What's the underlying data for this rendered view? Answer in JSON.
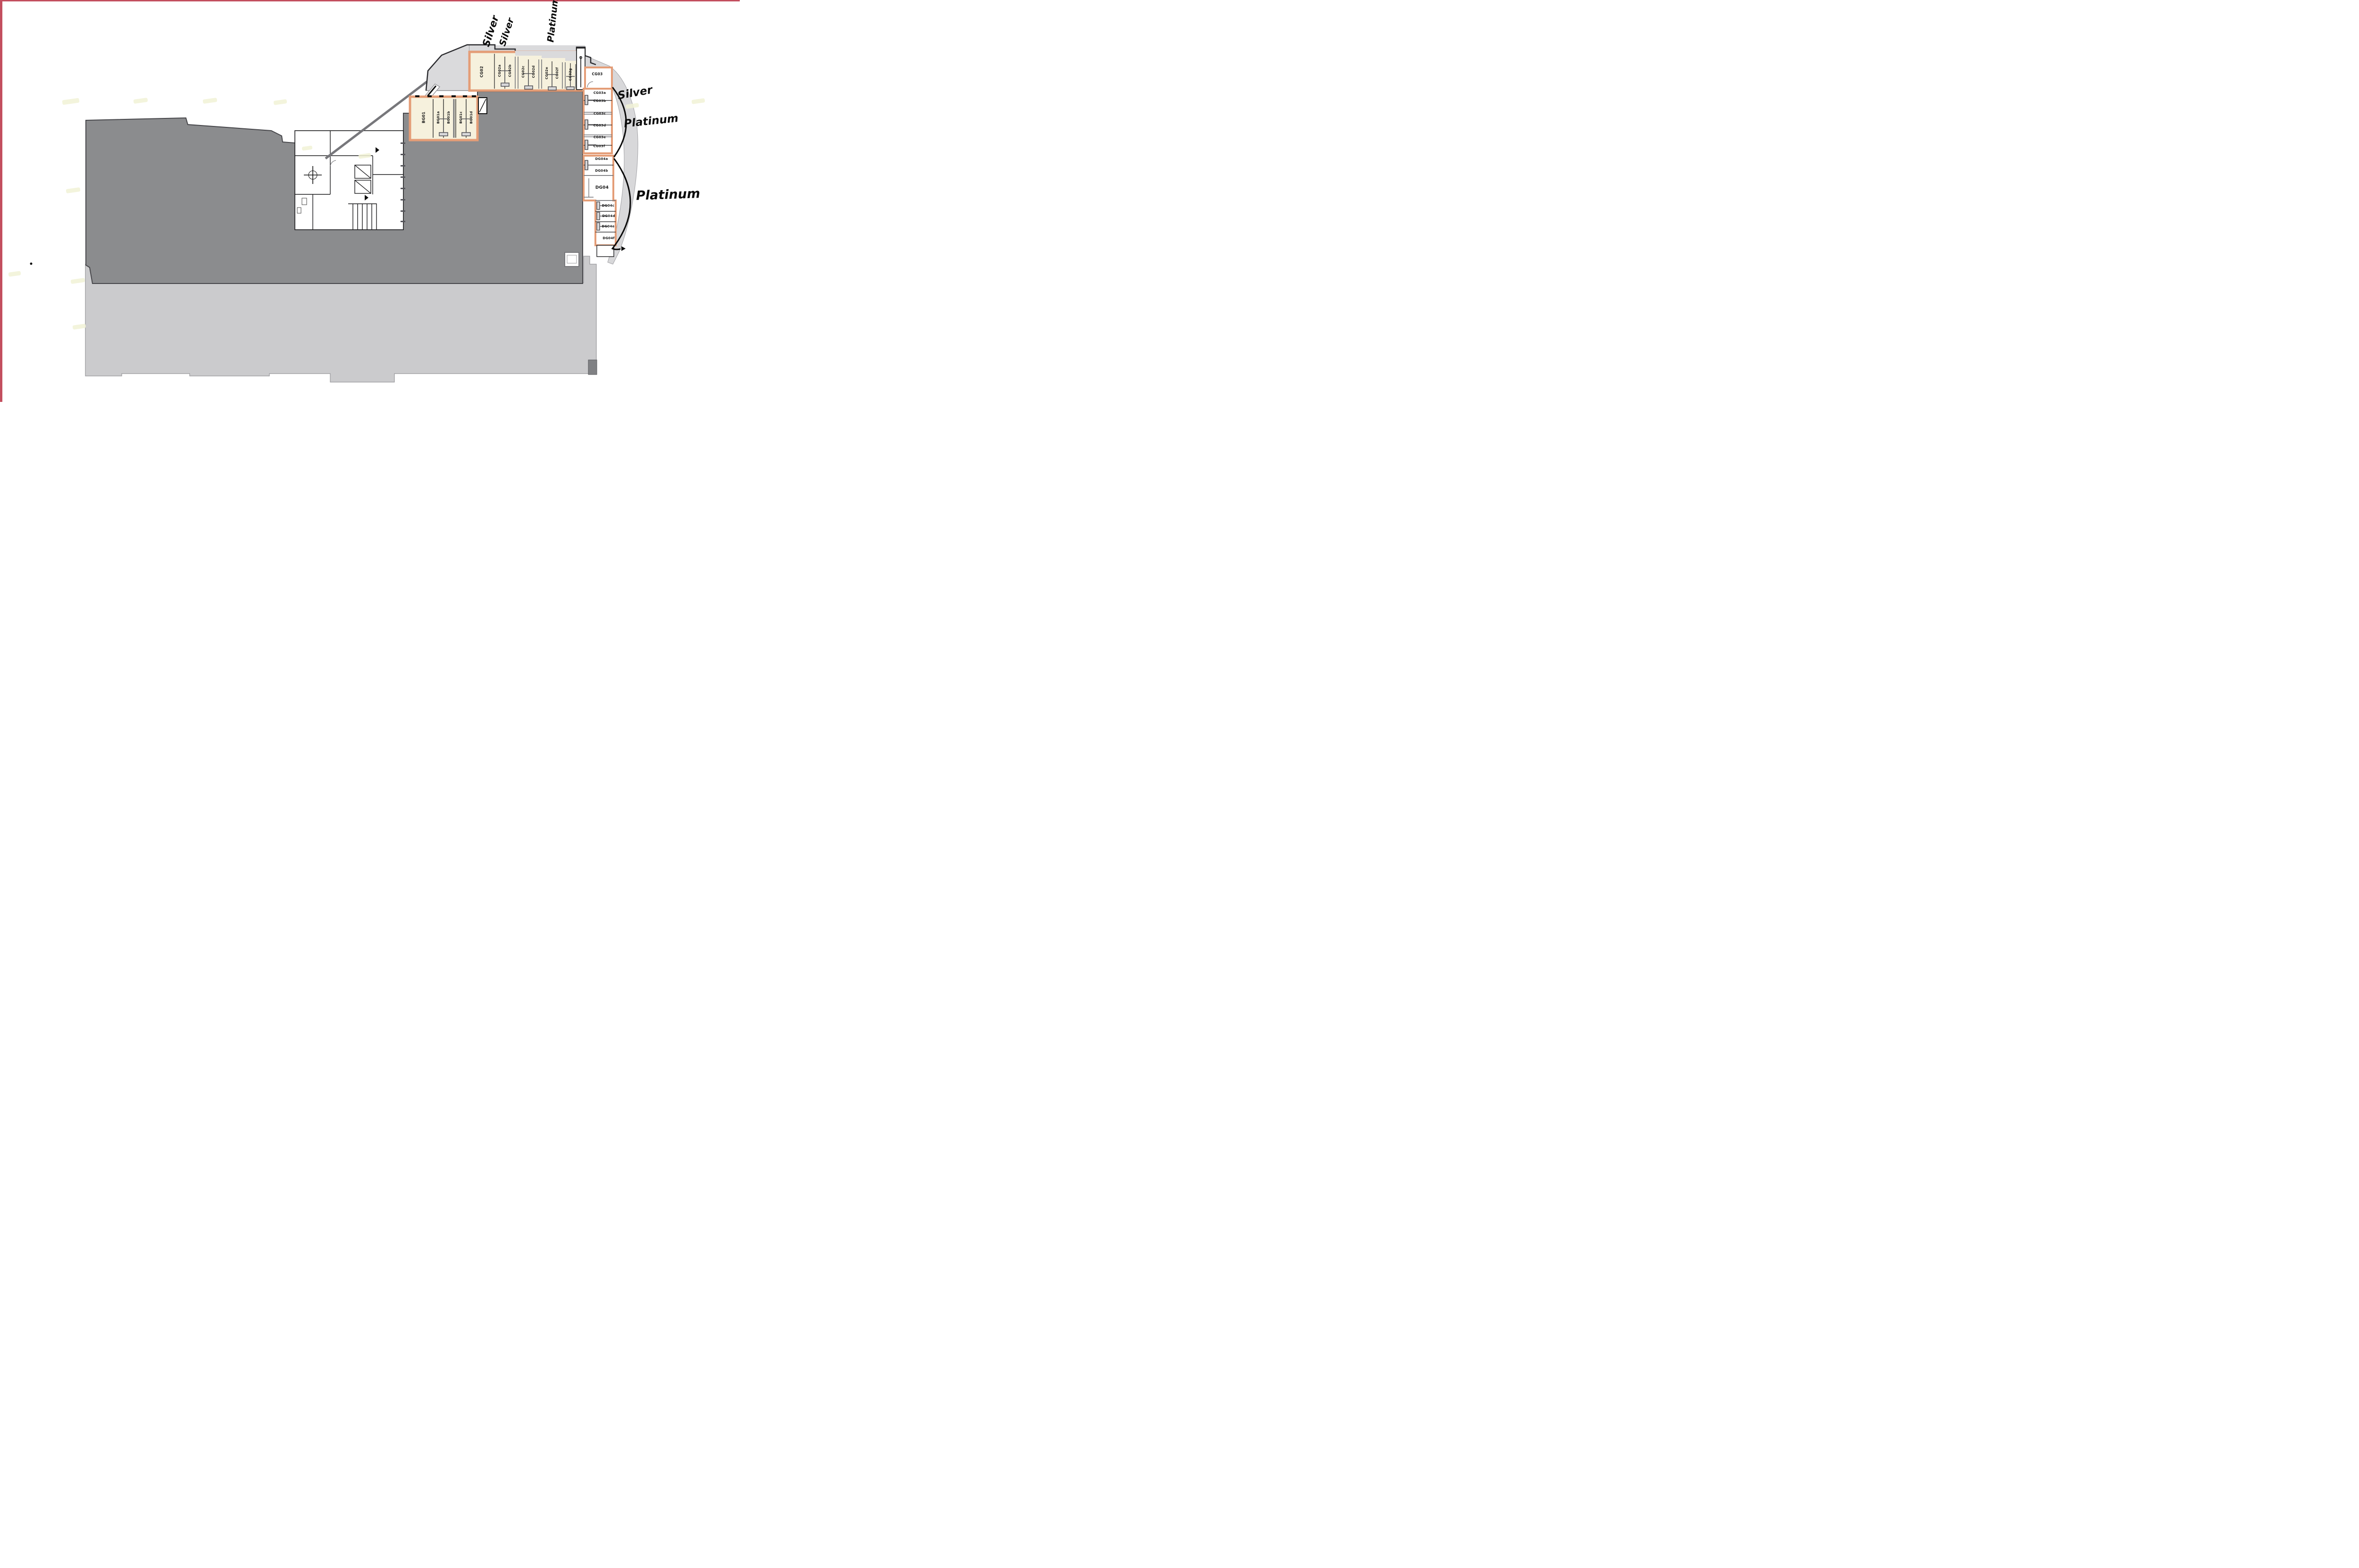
{
  "document": {
    "type": "architectural floor plan with handwritten tier annotations"
  },
  "blocks": {
    "cg02": {
      "rooms": [
        {
          "label": "CG02"
        },
        {
          "label": "CG02a"
        },
        {
          "label": "CG02b"
        },
        {
          "label": "CG02c"
        },
        {
          "label": "CG02d"
        },
        {
          "label": "CG02e"
        },
        {
          "label": "CG02f"
        },
        {
          "label": "CG02g"
        }
      ]
    },
    "bg01": {
      "rooms": [
        {
          "label": "BG01"
        },
        {
          "label": "BG01a"
        },
        {
          "label": "BG01b"
        },
        {
          "label": "BG01c"
        },
        {
          "label": "BG01d"
        }
      ]
    },
    "cg03": {
      "suite": "CG03",
      "rooms": [
        {
          "label": "CG03a"
        },
        {
          "label": "CG03b"
        },
        {
          "label": "CG03c"
        },
        {
          "label": "CG03d"
        },
        {
          "label": "CG03e"
        },
        {
          "label": "CG03f"
        }
      ]
    },
    "dg04": {
      "suite": "DG04",
      "rooms": [
        {
          "label": "DG04a"
        },
        {
          "label": "DG04b"
        },
        {
          "label": "DG04c"
        },
        {
          "label": "DG04d"
        },
        {
          "label": "DG04e"
        },
        {
          "label": "DG04f"
        }
      ]
    }
  },
  "annotations": {
    "silver_a": "Silver",
    "silver_b": "Silver",
    "platinum_top": "Platinum",
    "silver_right": "Silver",
    "platinum_right": "Platinum",
    "platinum_big": "Platinum"
  },
  "colors": {
    "frame_red": "#c34f5f",
    "dark_mass": "#8b8c8e",
    "dark_outline": "#47474b",
    "light_gray": "#d2d2d4",
    "cream_room": "#f6f1dd",
    "highlight_orange": "#e49d77",
    "ink": "#161616"
  }
}
